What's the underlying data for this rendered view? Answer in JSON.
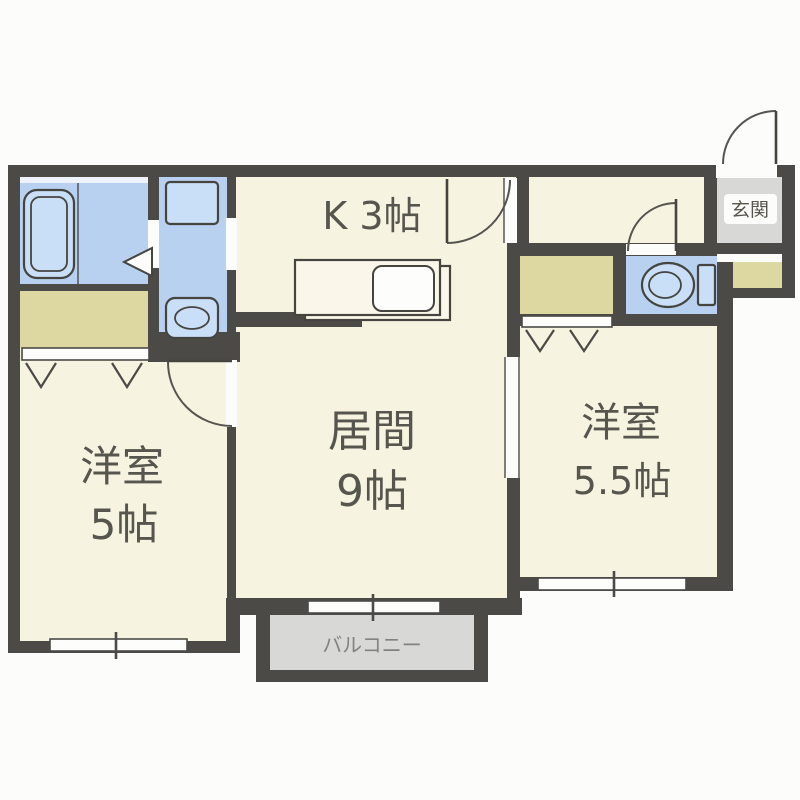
{
  "floor_plan": {
    "rooms": {
      "kitchen": {
        "label": "K 3帖"
      },
      "living": {
        "name": "居間",
        "size": "9帖"
      },
      "bedroom_west": {
        "name": "洋室",
        "size": "5帖"
      },
      "bedroom_east": {
        "name": "洋室",
        "size": "5.5帖"
      },
      "entrance": {
        "label": "玄関"
      },
      "balcony": {
        "label": "バルコニー"
      }
    },
    "palette": {
      "wall": "#4b4a46",
      "room_floor": "#f7f3e1",
      "wet_area": "#b8d1f0",
      "fixture_fill": "#c9def7",
      "closet": "#ddd7a2",
      "entrance_floor": "#d8d8d6",
      "balcony_floor": "#d8d8d6",
      "label_text": "#57564e",
      "background": "#fcfcfb"
    }
  }
}
